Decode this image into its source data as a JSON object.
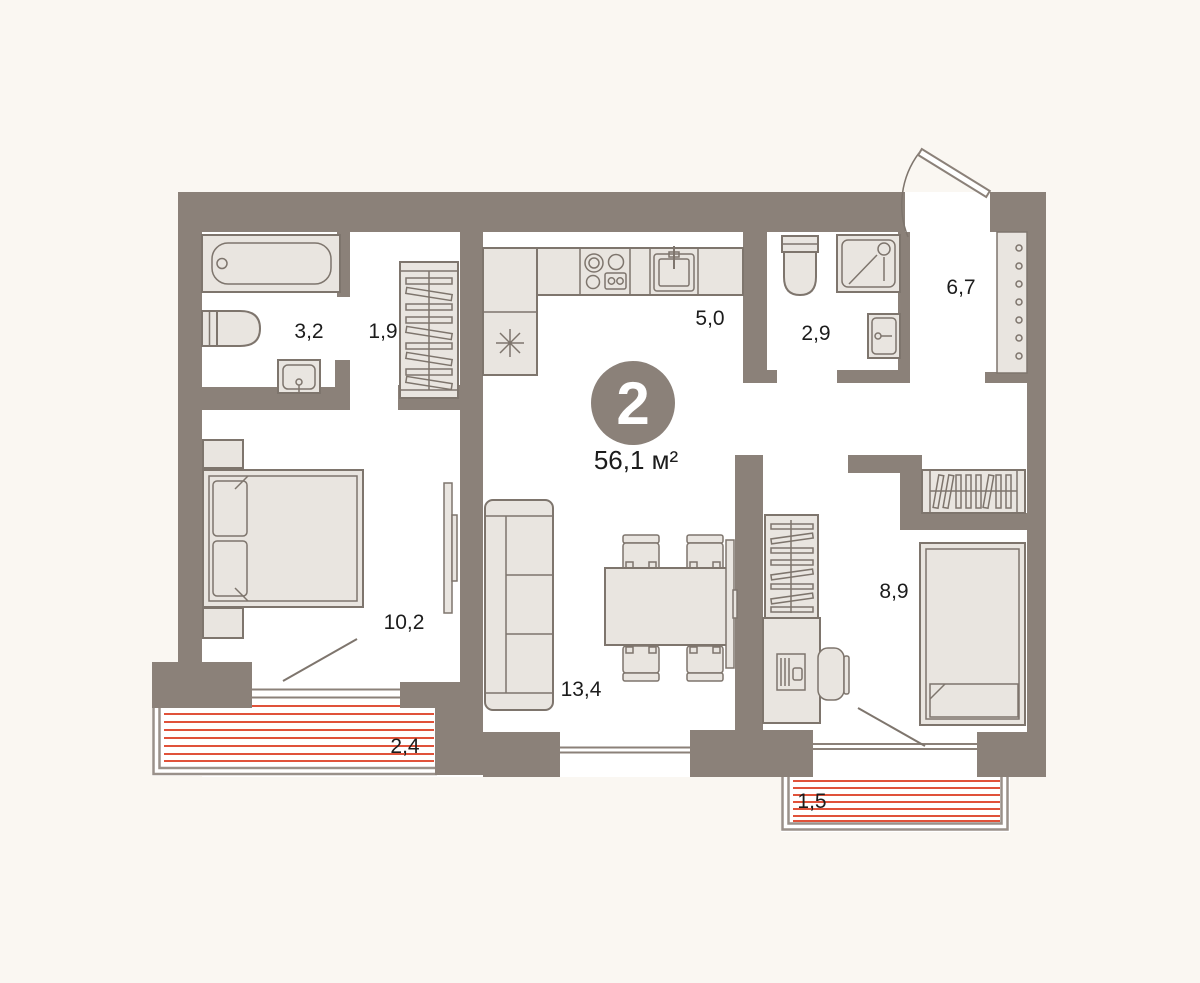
{
  "plan": {
    "type": "apartment-floor-plan",
    "badge": {
      "rooms_count": "2",
      "total_area": "56,1 м²"
    },
    "rooms": [
      {
        "id": "bathroom",
        "area": "3,2"
      },
      {
        "id": "hallway",
        "area": "1,9"
      },
      {
        "id": "kitchen",
        "area": "5,0"
      },
      {
        "id": "shower-room",
        "area": "2,9"
      },
      {
        "id": "entry-hall",
        "area": "6,7"
      },
      {
        "id": "bedroom",
        "area": "10,2"
      },
      {
        "id": "living-room",
        "area": "13,4"
      },
      {
        "id": "bedroom-2",
        "area": "8,9"
      },
      {
        "id": "balcony",
        "area": "2,4"
      },
      {
        "id": "balcony-2",
        "area": "1,5"
      }
    ],
    "colors": {
      "background": "#FAF7F2",
      "wall": "#8B8179",
      "furniture_fill": "#E9E5E0",
      "furniture_stroke": "#7E756D",
      "balcony_hatch": "#E0523A",
      "railing": "#9A918A",
      "text": "#1C1C1C",
      "badge_fill": "#8B8179",
      "badge_text": "#FFFFFF"
    }
  }
}
